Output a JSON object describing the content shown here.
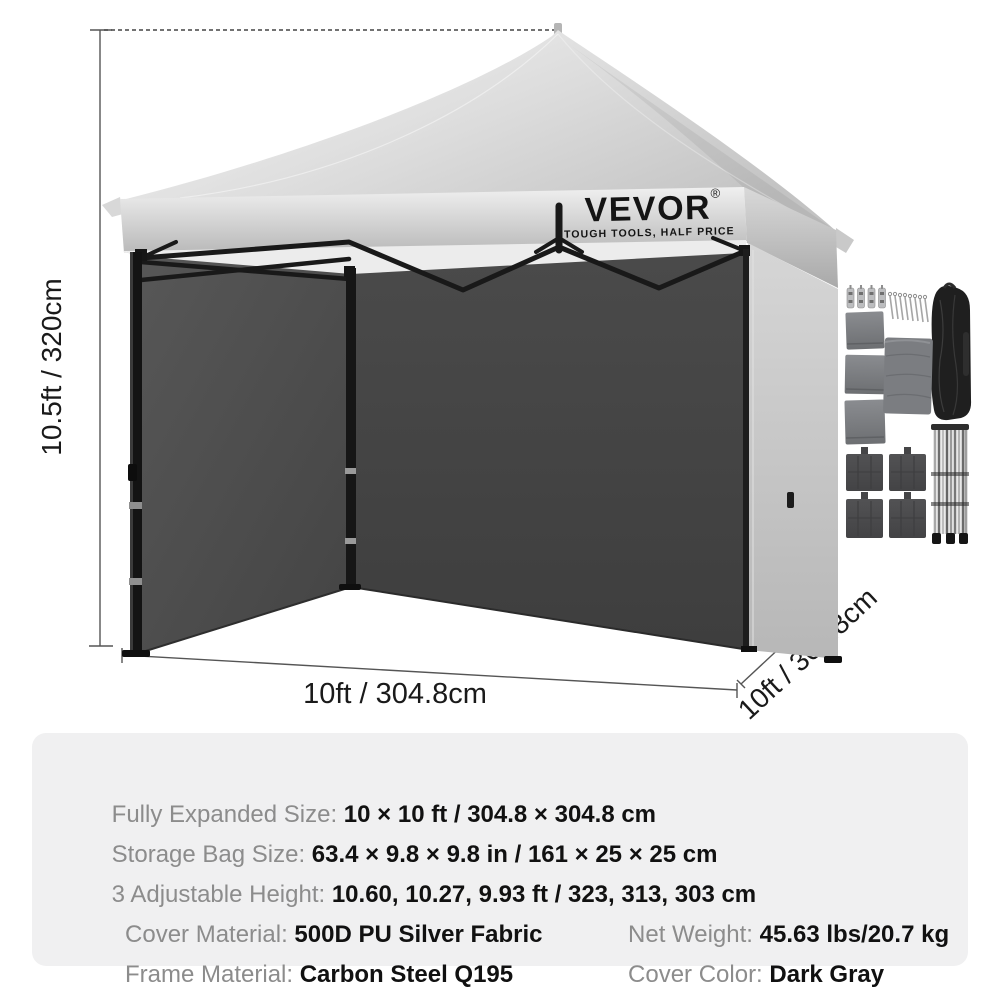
{
  "brand": {
    "logo": "VEVOR",
    "registered": "®",
    "tagline": "TOUGH TOOLS, HALF PRICE"
  },
  "dimensions": {
    "height_label": "10.5ft / 320cm",
    "width_label": "10ft / 304.8cm",
    "depth_label": "10ft / 304.8cm"
  },
  "specs": {
    "rows_full": [
      {
        "label": "Fully Expanded Size: ",
        "value": "10 × 10 ft / 304.8 × 304.8 cm"
      },
      {
        "label": "Storage Bag Size: ",
        "value": "63.4 × 9.8 × 9.8 in / 161 × 25 × 25 cm"
      },
      {
        "label": "3 Adjustable Height: ",
        "value": "10.60, 10.27, 9.93 ft / 323, 313, 303 cm"
      }
    ],
    "rows_cols": [
      {
        "label": "Cover Material: ",
        "value": "500D PU Silver Fabric"
      },
      {
        "label": "Net Weight: ",
        "value": "45.63 lbs/20.7 kg"
      },
      {
        "label": "Frame Material: ",
        "value": "Carbon Steel Q195"
      },
      {
        "label": "Cover Color: ",
        "value": "Dark Gray"
      }
    ]
  },
  "accessory_items": [
    "rope-tensioners",
    "tent-stakes",
    "folded-sidewalls",
    "folded-canopy-fabric",
    "storage-bag",
    "weight-bags",
    "folded-steel-frame"
  ],
  "colors": {
    "canopy_silver": "#d9d9d9",
    "wall_dark_gray": "#454545",
    "frame_black": "#1c1c1c",
    "panel_bg": "#f0f0f1",
    "label_gray": "#8c8c8c",
    "value_black": "#111111",
    "dimension_line": "#555555"
  }
}
